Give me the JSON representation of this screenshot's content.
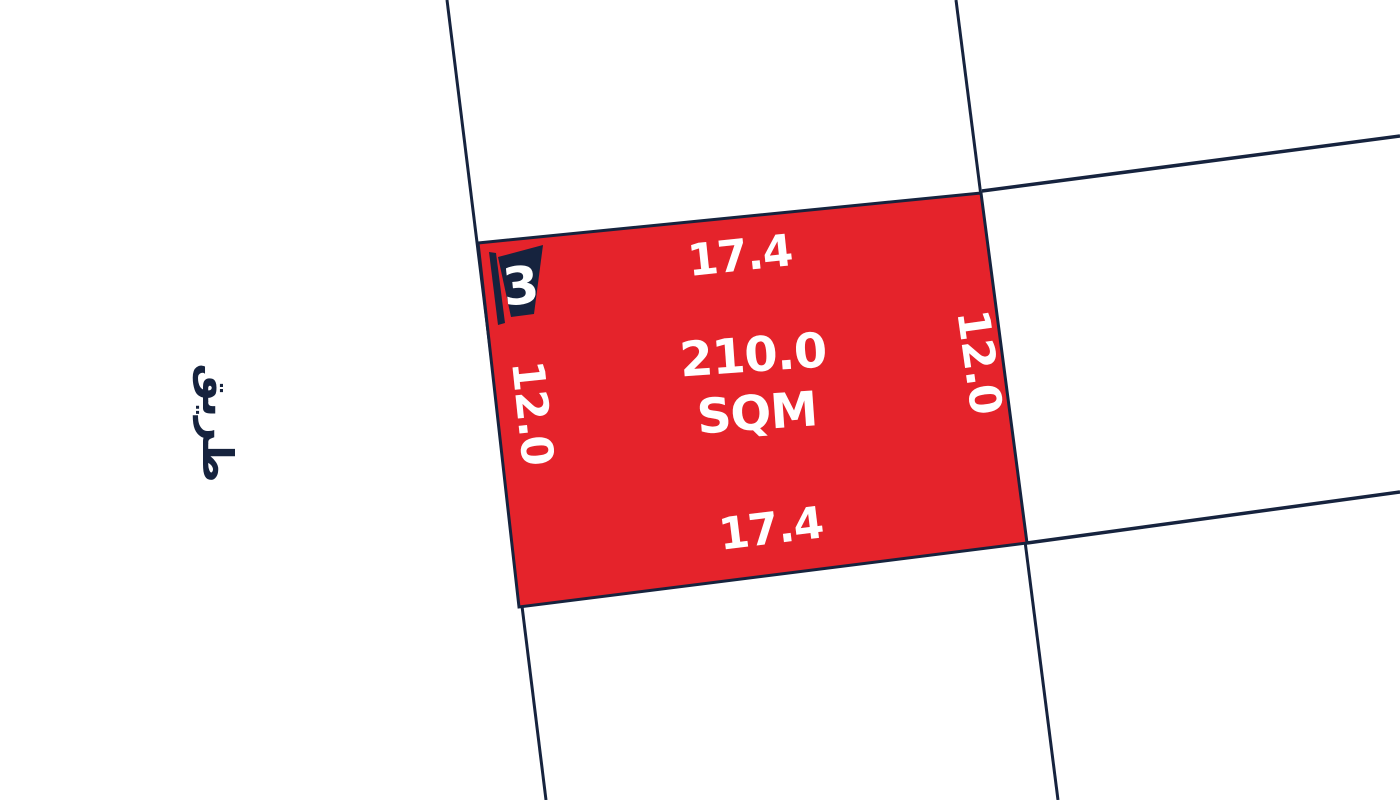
{
  "map": {
    "background_color": "#ffffff",
    "colors": {
      "plot_fill": "#E5232B",
      "boundary_line": "#16233E",
      "label_text": "#ffffff"
    },
    "plot": {
      "number": "3",
      "area_value": "210.0",
      "area_unit": "SQM",
      "dimensions": {
        "top": "17.4",
        "bottom": "17.4",
        "left": "12.0",
        "right": "12.0"
      }
    },
    "road": {
      "label": "طريق"
    }
  }
}
